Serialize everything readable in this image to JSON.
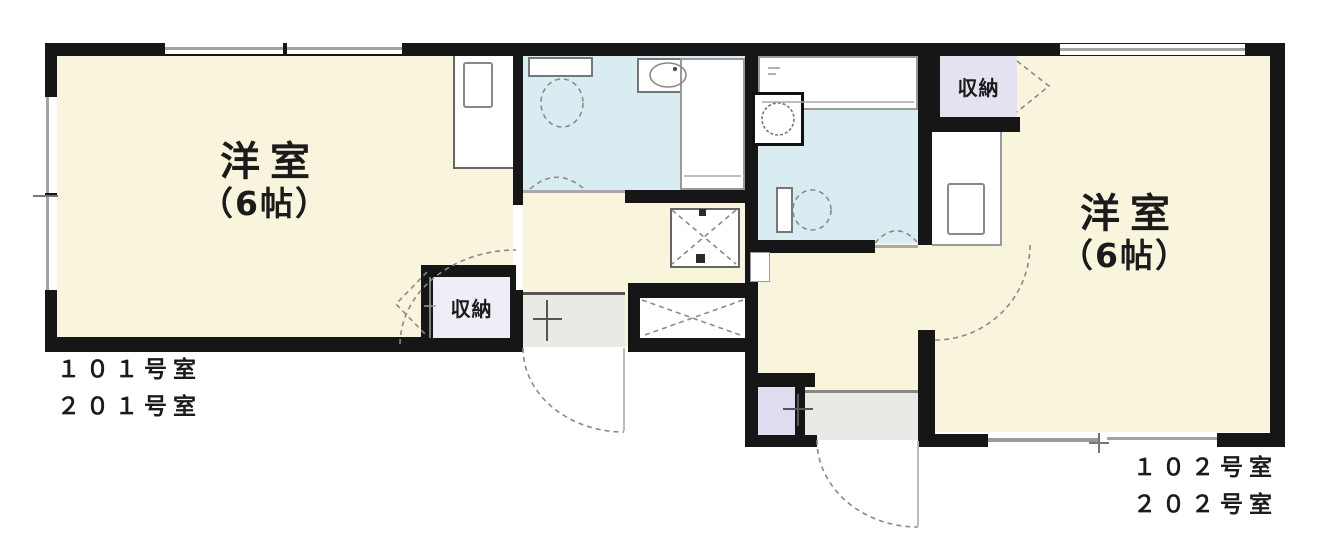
{
  "floorplan": {
    "left_unit": {
      "room_label": "洋室",
      "room_size": "（6帖）",
      "closet_label": "収納",
      "unit_number_line1": "１０１号室",
      "unit_number_line2": "２０１号室"
    },
    "right_unit": {
      "room_label": "洋室",
      "room_size": "（6帖）",
      "closet_label": "収納",
      "unit_number_line1": "１０２号室",
      "unit_number_line2": "２０２号室"
    },
    "colors": {
      "wall": "#161616",
      "room_fill": "#f8f5dc",
      "bath_fill": "#d9ecf2",
      "closet_fill": "#e4e2f1",
      "closet_fill_light": "#efeef6",
      "shoe_fill": "#dedcef",
      "entry_fill": "#e9e9e5",
      "fixture_line": "#8a8a8a"
    }
  }
}
